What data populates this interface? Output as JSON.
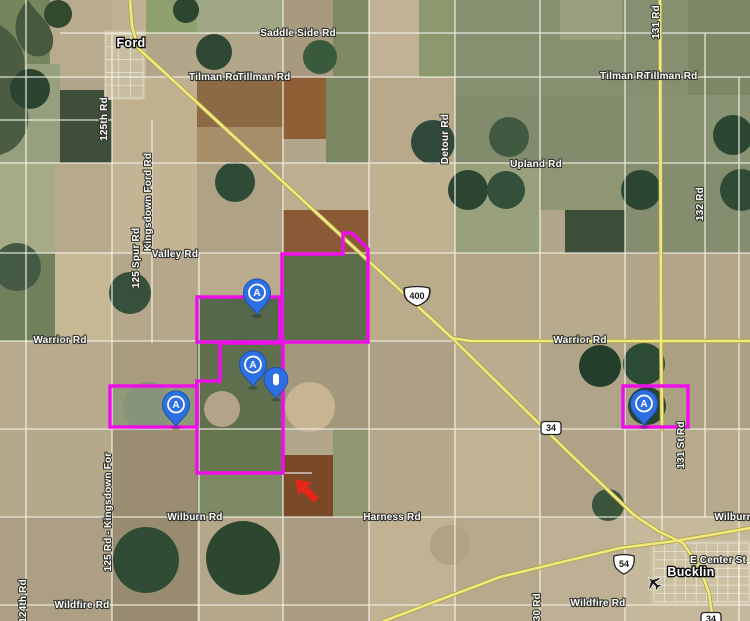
{
  "map": {
    "width": 750,
    "height": 621,
    "bg_color": "#b2a68a",
    "parcel_color": "#ee0fe8",
    "road_minor_color": "#f4f3ec",
    "highway_fill": "#f1e97c",
    "highway_casing": "#a9a052",
    "fields": [
      [
        50,
        0,
        62,
        77,
        "#b9ab8e"
      ],
      [
        112,
        0,
        34,
        33,
        "#c0b194"
      ],
      [
        146,
        0,
        51,
        33,
        "#8fa06f"
      ],
      [
        197,
        0,
        86,
        33,
        "#9fa683"
      ],
      [
        283,
        0,
        50,
        77,
        "#a89a7e"
      ],
      [
        333,
        0,
        36,
        77,
        "#7e8a62"
      ],
      [
        369,
        0,
        50,
        77,
        "#c2b295"
      ],
      [
        419,
        0,
        36,
        77,
        "#8e986f"
      ],
      [
        455,
        0,
        295,
        95,
        "#868f70"
      ],
      [
        560,
        0,
        62,
        40,
        "#99a07d"
      ],
      [
        688,
        0,
        62,
        95,
        "#7d8766"
      ],
      [
        0,
        0,
        50,
        64,
        "#76855c"
      ],
      [
        0,
        64,
        60,
        99,
        "#96a07e"
      ],
      [
        60,
        90,
        52,
        73,
        "#3f4f3a"
      ],
      [
        112,
        77,
        85,
        86,
        "#c0b08f"
      ],
      [
        197,
        77,
        86,
        50,
        "#8b6a44"
      ],
      [
        197,
        127,
        86,
        36,
        "#a58e68"
      ],
      [
        283,
        77,
        43,
        62,
        "#915f35"
      ],
      [
        326,
        77,
        43,
        86,
        "#7b8760"
      ],
      [
        369,
        77,
        86,
        86,
        "#b7a98a"
      ],
      [
        455,
        95,
        170,
        68,
        "#828c6d"
      ],
      [
        625,
        95,
        125,
        68,
        "#899272"
      ],
      [
        0,
        163,
        55,
        90,
        "#a4ab85"
      ],
      [
        55,
        163,
        57,
        90,
        "#b6aa8b"
      ],
      [
        112,
        163,
        85,
        90,
        "#c3b493"
      ],
      [
        197,
        163,
        86,
        90,
        "#b0a284"
      ],
      [
        283,
        163,
        86,
        47,
        "#bcae8f"
      ],
      [
        283,
        210,
        86,
        44,
        "#8a5a36"
      ],
      [
        369,
        163,
        86,
        90,
        "#c0b191"
      ],
      [
        455,
        163,
        85,
        90,
        "#99a07c"
      ],
      [
        540,
        163,
        85,
        47,
        "#8e9673"
      ],
      [
        565,
        210,
        60,
        43,
        "#3d4e38"
      ],
      [
        625,
        163,
        125,
        90,
        "#848d6e"
      ],
      [
        0,
        253,
        55,
        88,
        "#70805a"
      ],
      [
        55,
        253,
        57,
        88,
        "#c6b795"
      ],
      [
        112,
        253,
        85,
        88,
        "#b4a78a"
      ],
      [
        197,
        253,
        86,
        44,
        "#b9ab8c"
      ],
      [
        197,
        297,
        83,
        45,
        "#55684a"
      ],
      [
        283,
        254,
        86,
        88,
        "#5d6d4b"
      ],
      [
        369,
        253,
        86,
        88,
        "#baab8b"
      ],
      [
        455,
        253,
        85,
        88,
        "#b1a487"
      ],
      [
        540,
        253,
        85,
        88,
        "#b7aa8d"
      ],
      [
        625,
        253,
        125,
        88,
        "#b3a588"
      ],
      [
        0,
        341,
        112,
        88,
        "#b8aa8c"
      ],
      [
        112,
        341,
        85,
        46,
        "#a89b7e"
      ],
      [
        112,
        387,
        85,
        41,
        "#8e9a78"
      ],
      [
        197,
        341,
        86,
        88,
        "#60704e"
      ],
      [
        283,
        341,
        86,
        88,
        "#a2987c"
      ],
      [
        369,
        341,
        86,
        88,
        "#ada084"
      ],
      [
        455,
        341,
        85,
        88,
        "#baac8e"
      ],
      [
        540,
        341,
        85,
        88,
        "#b1a589"
      ],
      [
        625,
        341,
        125,
        88,
        "#aca083"
      ],
      [
        0,
        429,
        112,
        88,
        "#b5a98c"
      ],
      [
        112,
        429,
        85,
        88,
        "#9a8d72"
      ],
      [
        197,
        429,
        86,
        44,
        "#66764f"
      ],
      [
        197,
        473,
        86,
        44,
        "#7d8a64"
      ],
      [
        283,
        455,
        50,
        62,
        "#7a4a28"
      ],
      [
        333,
        429,
        36,
        88,
        "#8f9770"
      ],
      [
        369,
        429,
        86,
        88,
        "#b6a98b"
      ],
      [
        455,
        429,
        85,
        88,
        "#c0b293"
      ],
      [
        540,
        429,
        85,
        88,
        "#afa286"
      ],
      [
        625,
        429,
        125,
        88,
        "#b8ab8d"
      ],
      [
        0,
        517,
        112,
        104,
        "#ac9f83"
      ],
      [
        112,
        517,
        85,
        104,
        "#988b6f"
      ],
      [
        197,
        517,
        86,
        104,
        "#b4a78a"
      ],
      [
        283,
        517,
        86,
        104,
        "#a99c80"
      ],
      [
        369,
        517,
        86,
        104,
        "#c1b294"
      ],
      [
        455,
        517,
        85,
        104,
        "#b7aa8c"
      ],
      [
        540,
        517,
        85,
        104,
        "#bdb094"
      ],
      [
        625,
        517,
        125,
        104,
        "#c6b89a"
      ],
      [
        104,
        30,
        42,
        70,
        "#c9bd9f"
      ],
      [
        650,
        540,
        100,
        64,
        "#cdc1a4"
      ]
    ],
    "woodland_blobs": [
      [
        "M0,25 C22,38 34,66 16,92 C38,110 28,142 8,152 L0,155 Z",
        "#4a5c41"
      ],
      [
        "M28,0 C40,18 58,28 52,48 C44,62 24,58 18,40 C12,24 18,10 28,0 Z",
        "#46583e"
      ]
    ],
    "pivot_circles": [
      [
        214,
        52,
        18,
        "#2e4733"
      ],
      [
        320,
        57,
        17,
        "#3a5a3d"
      ],
      [
        30,
        89,
        20,
        "#2b4430"
      ],
      [
        58,
        14,
        14,
        "#30492f"
      ],
      [
        186,
        10,
        13,
        "#2c452f"
      ],
      [
        433,
        142,
        22,
        "#31493a"
      ],
      [
        509,
        137,
        20,
        "#3f5a40"
      ],
      [
        733,
        135,
        20,
        "#2b4631"
      ],
      [
        235,
        182,
        20,
        "#2f4a35"
      ],
      [
        17,
        267,
        24,
        "#445a44"
      ],
      [
        130,
        293,
        21,
        "#37503b"
      ],
      [
        468,
        190,
        20,
        "#2c4531"
      ],
      [
        506,
        190,
        19,
        "#33503a"
      ],
      [
        641,
        190,
        20,
        "#2b4733"
      ],
      [
        741,
        190,
        21,
        "#2f4b36"
      ],
      [
        600,
        366,
        21,
        "#243e2c"
      ],
      [
        644,
        364,
        21,
        "#2c4a34"
      ],
      [
        647,
        406,
        19,
        "#2a452f"
      ],
      [
        148,
        407,
        25,
        "#87937b"
      ],
      [
        222,
        409,
        18,
        "#b3a489"
      ],
      [
        310,
        407,
        25,
        "#c6b493"
      ],
      [
        238,
        320,
        21,
        "#546849"
      ],
      [
        243,
        558,
        37,
        "#2c462f"
      ],
      [
        146,
        560,
        33,
        "#314c34"
      ],
      [
        450,
        545,
        20,
        "#b1a284"
      ],
      [
        608,
        505,
        16,
        "#3a553c"
      ]
    ],
    "minor_roads": [
      [
        26,
        0,
        26,
        621
      ],
      [
        112,
        33,
        112,
        621
      ],
      [
        152,
        120,
        152,
        343
      ],
      [
        199,
        253,
        199,
        621
      ],
      [
        283,
        0,
        283,
        621
      ],
      [
        369,
        0,
        369,
        621
      ],
      [
        455,
        0,
        455,
        621
      ],
      [
        540,
        0,
        540,
        621
      ],
      [
        625,
        0,
        625,
        621
      ],
      [
        705,
        33,
        705,
        517
      ],
      [
        739,
        77,
        739,
        621
      ],
      [
        662,
        429,
        662,
        543
      ],
      [
        60,
        33,
        750,
        33
      ],
      [
        0,
        77,
        750,
        77
      ],
      [
        0,
        120,
        112,
        120
      ],
      [
        0,
        163,
        750,
        163
      ],
      [
        0,
        253,
        750,
        253
      ],
      [
        0,
        341,
        458,
        341
      ],
      [
        0,
        429,
        750,
        429
      ],
      [
        0,
        517,
        750,
        517
      ],
      [
        0,
        605,
        750,
        605
      ],
      [
        197,
        473,
        312,
        473
      ],
      [
        688,
        563,
        750,
        563
      ]
    ],
    "street_grids": [
      {
        "name": "ford-streets",
        "x0": 106,
        "y0": 34,
        "x1": 143,
        "y1": 98,
        "cols": 3,
        "rows": 5
      },
      {
        "name": "bucklin-streets",
        "x0": 654,
        "y0": 543,
        "x1": 749,
        "y1": 602,
        "cols": 9,
        "rows": 7
      }
    ],
    "highways": [
      {
        "name": "US-400",
        "points": "130,0 132,26 138,48 452,338"
      },
      {
        "name": "US-400-east",
        "points": "452,338 470,341 750,341"
      },
      {
        "name": "K-34-diagonal",
        "points": "452,338 566,450 634,515 658,531 683,543"
      },
      {
        "name": "US-54",
        "points": "384,621 500,577 620,548 675,541 750,528"
      },
      {
        "name": "K-34-south",
        "points": "683,543 700,568 709,593 713,621"
      },
      {
        "name": "131-Rd",
        "points": "660,0 661,341 662,429"
      }
    ],
    "parcels": [
      {
        "name": "parcel-northwest",
        "points": "197,297 280,297 280,342 197,342"
      },
      {
        "name": "parcel-large-east",
        "points": "282,342 282,254 343,254 343,233 352,233 368,249 368,342"
      },
      {
        "name": "parcel-center-south",
        "points": "220,343 283,343 283,473 197,473 197,381 220,381"
      },
      {
        "name": "parcel-west",
        "points": "110,386 197,386 197,427 110,427"
      },
      {
        "name": "parcel-far-east",
        "points": "623,386 688,386 688,427 623,427"
      }
    ],
    "shields": [
      {
        "type": "us",
        "label": "400",
        "x": 417,
        "y": 296
      },
      {
        "type": "us",
        "label": "54",
        "x": 624,
        "y": 564
      },
      {
        "type": "state",
        "label": "34",
        "x": 551,
        "y": 428
      },
      {
        "type": "state",
        "label": "34",
        "x": 711,
        "y": 619
      }
    ],
    "labels": [
      {
        "text": "Saddle Side Rd",
        "x": 298,
        "y": 36,
        "rot": 0,
        "kind": "road"
      },
      {
        "text": "Tilman Rd",
        "x": 214,
        "y": 80,
        "rot": 0,
        "kind": "road"
      },
      {
        "text": "Tillman Rd",
        "x": 264,
        "y": 80,
        "rot": 0,
        "kind": "road"
      },
      {
        "text": "Tilman Rd",
        "x": 625,
        "y": 79,
        "rot": 0,
        "kind": "road"
      },
      {
        "text": "Tillman Rd",
        "x": 671,
        "y": 79,
        "rot": 0,
        "kind": "road"
      },
      {
        "text": "131 Rd",
        "x": 659,
        "y": 22,
        "rot": -90,
        "kind": "road"
      },
      {
        "text": "125th Rd",
        "x": 107,
        "y": 119,
        "rot": -90,
        "kind": "road"
      },
      {
        "text": "Detour Rd",
        "x": 448,
        "y": 139,
        "rot": -90,
        "kind": "road"
      },
      {
        "text": "Upland Rd",
        "x": 536,
        "y": 167,
        "rot": 0,
        "kind": "road"
      },
      {
        "text": "132 Rd",
        "x": 703,
        "y": 204,
        "rot": -90,
        "kind": "road"
      },
      {
        "text": "Kingsdown Ford Rd",
        "x": 151,
        "y": 202,
        "rot": -90,
        "kind": "road"
      },
      {
        "text": "125 Spur Rd",
        "x": 139,
        "y": 258,
        "rot": -90,
        "kind": "road"
      },
      {
        "text": "Valley Rd",
        "x": 175,
        "y": 257,
        "rot": 0,
        "kind": "road"
      },
      {
        "text": "Warrior Rd",
        "x": 60,
        "y": 343,
        "rot": 0,
        "kind": "road"
      },
      {
        "text": "Warrior Rd",
        "x": 580,
        "y": 343,
        "rot": 0,
        "kind": "road"
      },
      {
        "text": "131 St Rd",
        "x": 684,
        "y": 445,
        "rot": -90,
        "kind": "road"
      },
      {
        "text": "Wilburn Rd",
        "x": 195,
        "y": 520,
        "rot": 0,
        "kind": "road"
      },
      {
        "text": "Harness Rd",
        "x": 392,
        "y": 520,
        "rot": 0,
        "kind": "road"
      },
      {
        "text": "Wilburn Rd",
        "x": 742,
        "y": 520,
        "rot": 0,
        "kind": "road"
      },
      {
        "text": "125 Rd - Kingsdown For",
        "x": 111,
        "y": 512,
        "rot": -90,
        "kind": "road"
      },
      {
        "text": "Wildfire Rd",
        "x": 82,
        "y": 608,
        "rot": 0,
        "kind": "road"
      },
      {
        "text": "Wildfire Rd",
        "x": 598,
        "y": 606,
        "rot": 0,
        "kind": "road"
      },
      {
        "text": "124th Rd",
        "x": 26,
        "y": 601,
        "rot": -90,
        "kind": "road"
      },
      {
        "text": "130 Rd",
        "x": 540,
        "y": 610,
        "rot": -90,
        "kind": "road"
      },
      {
        "text": "E Center St",
        "x": 718,
        "y": 563,
        "rot": 0,
        "kind": "road"
      },
      {
        "text": "Ford",
        "x": 131,
        "y": 47,
        "rot": 0,
        "kind": "town"
      },
      {
        "text": "Bucklin",
        "x": 691,
        "y": 576,
        "rot": 0,
        "kind": "town"
      }
    ],
    "markers": [
      {
        "type": "A",
        "label": "A",
        "x": 257,
        "y": 315
      },
      {
        "type": "A",
        "label": "A",
        "x": 253,
        "y": 387
      },
      {
        "type": "custom",
        "label": "",
        "x": 276,
        "y": 399
      },
      {
        "type": "A",
        "label": "A",
        "x": 176,
        "y": 427
      },
      {
        "type": "A",
        "label": "A",
        "x": 644,
        "y": 426
      }
    ],
    "marker_colors": {
      "pin_fill": "#2e6fe3",
      "pin_stroke": "#1d4fb0",
      "glyph": "#ffffff"
    },
    "arrow": {
      "tip_x": 295,
      "tip_y": 479,
      "rotation": -45,
      "color": "#e8251a"
    },
    "airport": {
      "x": 653,
      "y": 582,
      "rotation": -45,
      "color": "#1c1c1c"
    }
  }
}
